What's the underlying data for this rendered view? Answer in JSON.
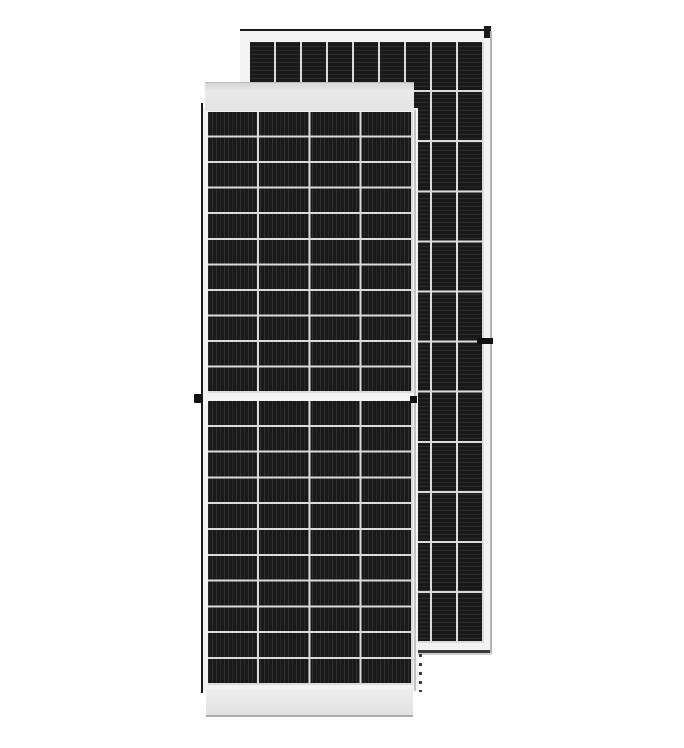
{
  "scene": {
    "type": "product-photo",
    "subject": "Two framed monocrystalline half-cut solar panels on a white background; one panel faces the viewer, a second identical panel stands behind it offset up and to the right",
    "background_color": "#ffffff"
  },
  "front_panel": {
    "view": "front",
    "orientation": "portrait",
    "cell_columns": 4,
    "cell_rows_upper_half": 11,
    "cell_rows_lower_half": 11,
    "half_cut_center_gap": true,
    "frame_bands": [
      "top",
      "bottom"
    ],
    "grounding_clips": [
      "left-middle",
      "right-middle"
    ]
  },
  "rear_panel": {
    "view": "rear",
    "orientation": "portrait",
    "cell_columns": 9,
    "cell_rows": 12,
    "grounding_clips": [
      "right-middle"
    ],
    "corner_mark": "top-right"
  },
  "colors": {
    "--bg": "#ffffff",
    "--cell": "#191919",
    "--grid": "#d8dcdb",
    "--frame-light": "#f3f3f3",
    "--frame-band": "#e9e9e9",
    "--edge-dark": "#1a1a1a",
    "--edge-gray": "#c4c4c4"
  }
}
